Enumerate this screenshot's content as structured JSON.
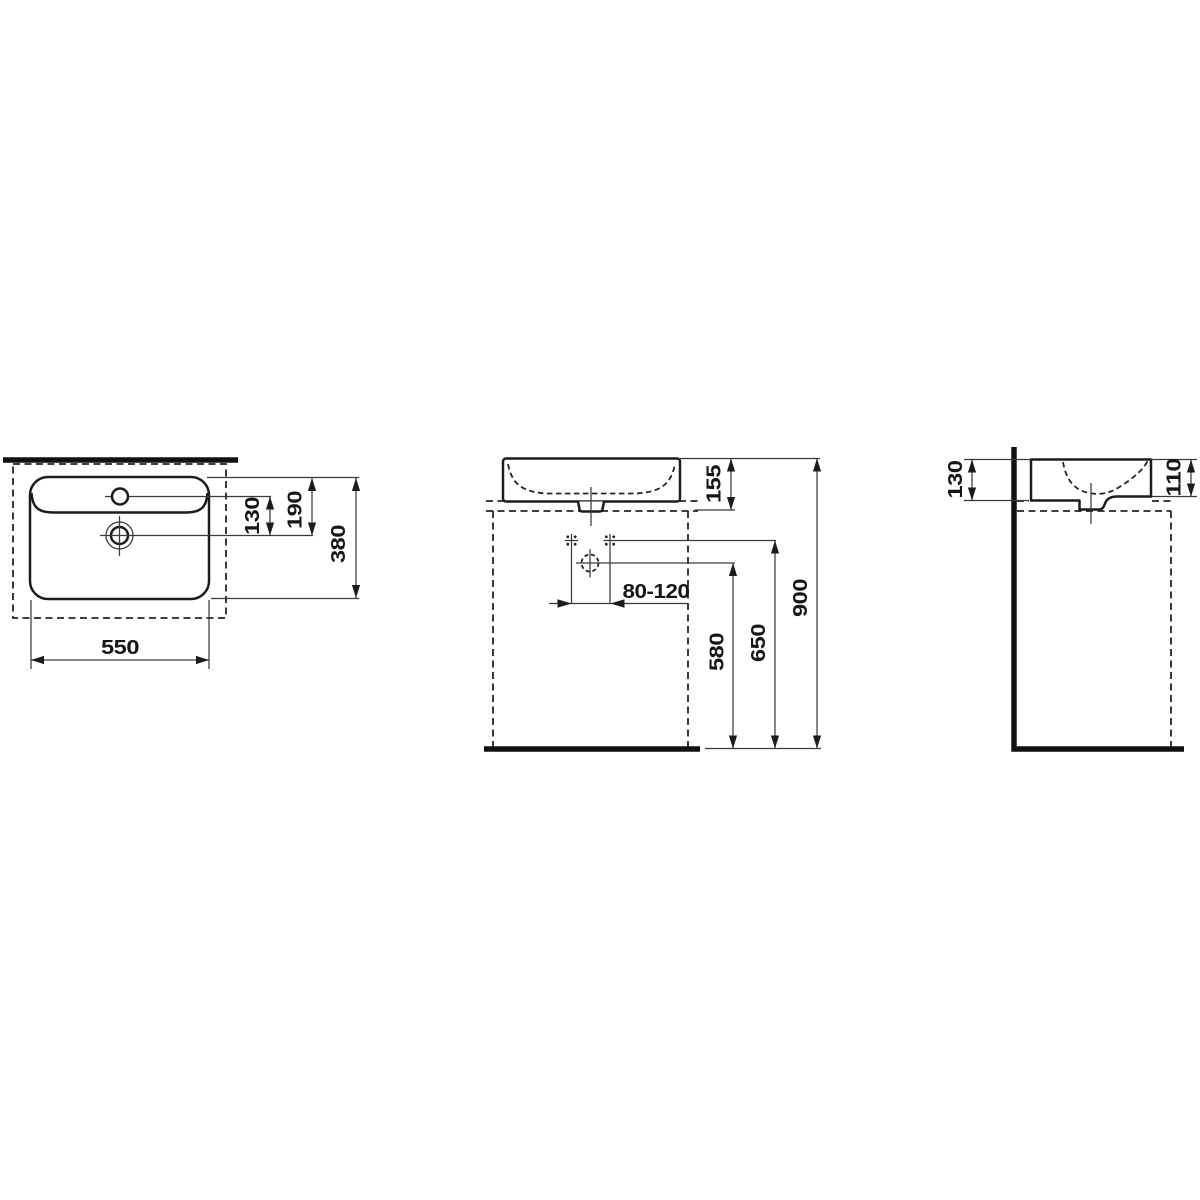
{
  "drawing": {
    "type": "washbasin-installation-dimension-drawing",
    "units": "mm",
    "colors": {
      "ink": "#1c1c1c",
      "background": "#ffffff"
    },
    "views": {
      "top": {
        "dims": {
          "tap_to_drain": "130",
          "rim_to_drain": "190",
          "depth": "380",
          "width": "550"
        }
      },
      "front": {
        "dims": {
          "basin_height": "155",
          "faucet_offset": "80-120",
          "drain_height": "580",
          "connection_height": "650",
          "rim_height": "900"
        }
      },
      "side": {
        "dims": {
          "back_height": "130",
          "front_height": "110"
        }
      }
    }
  }
}
